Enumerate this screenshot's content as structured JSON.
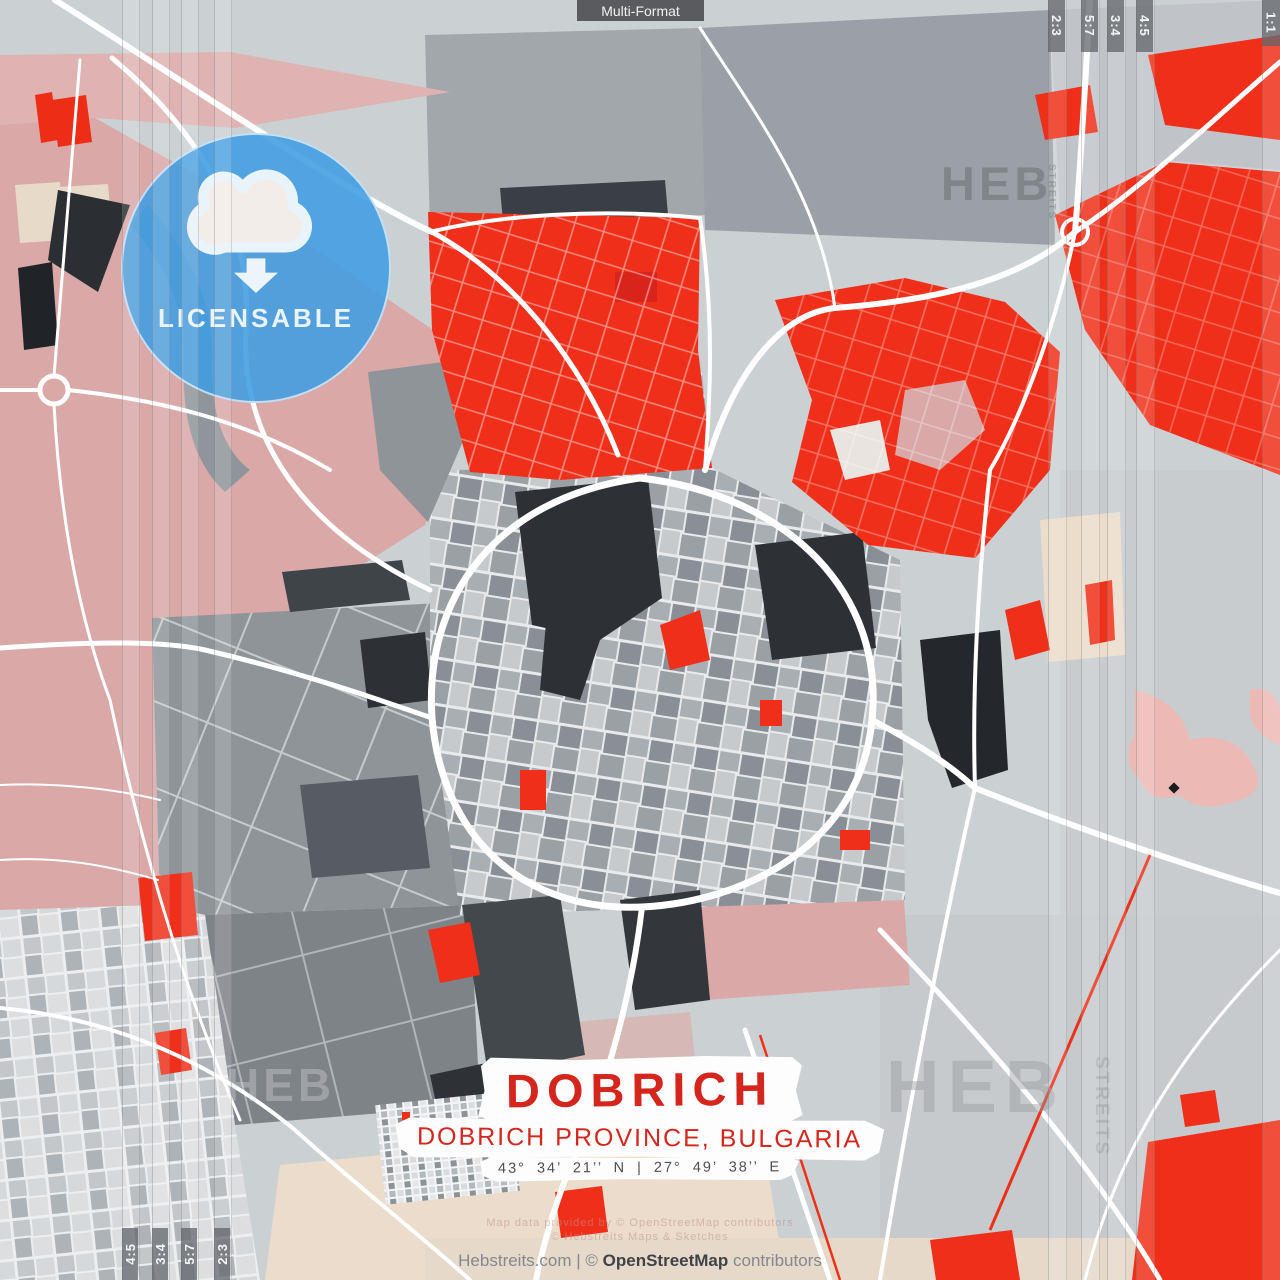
{
  "poster": {
    "top_label": "Multi-Format",
    "badge": {
      "label": "LICENSABLE"
    },
    "title_block": {
      "title": "DOBRICH",
      "subtitle": "DOBRICH PROVINCE, BULGARIA",
      "coordinates": "43°  34’  21’’ N  |  27°  49’  38’’ E"
    },
    "crop_marks": {
      "top_right": [
        "2:3",
        "5:7",
        "3:4",
        "4:5"
      ],
      "top_right_corner": "1:1",
      "bottom_left": [
        "4:5",
        "3:4",
        "5:7",
        "2:3"
      ]
    },
    "watermarks": {
      "brand": "HEB",
      "brand_vertical": "STREITS",
      "attribution_line1": "Map data provided by © OpenStreetMap contributors",
      "attribution_line2": "© Hebstreits Maps & Sketches"
    },
    "footer": {
      "prefix": "Hebstreits.com | © ",
      "bold": "OpenStreetMap",
      "suffix": " contributors"
    },
    "colors": {
      "map_red": "#ef2f1a",
      "title_red": "#d4261c",
      "badge_blue": "#409de2",
      "map_pink": "#d9a8a7",
      "map_beige": "#ecdccb",
      "map_gray_light": "#cbd0d3",
      "map_gray_medium": "#9aa0a4",
      "map_charcoal": "#2d3136"
    }
  }
}
